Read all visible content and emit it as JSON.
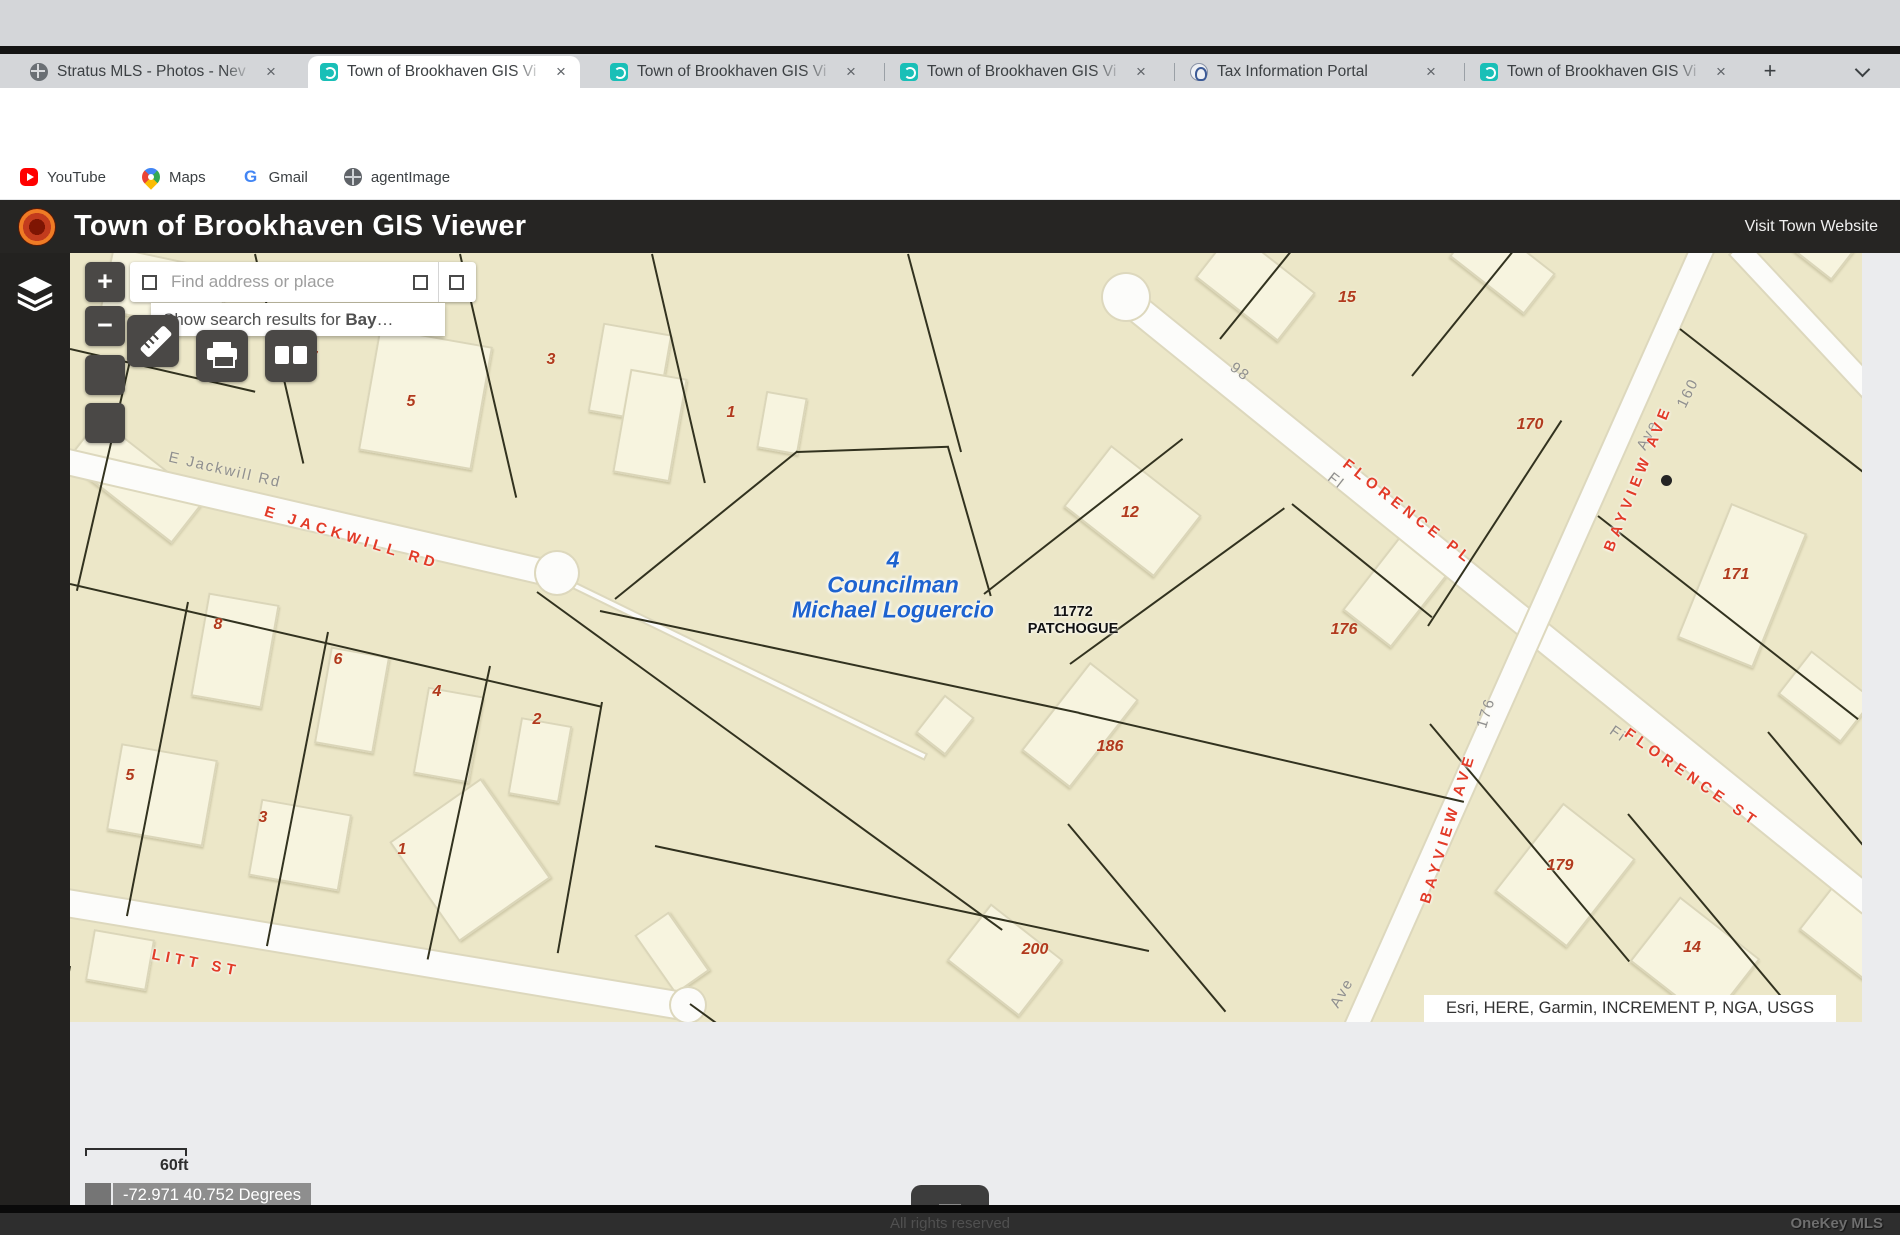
{
  "browser": {
    "tabs": [
      {
        "title": "Stratus MLS - Photos - Nev",
        "icon": "globe",
        "active": false
      },
      {
        "title": "Town of Brookhaven GIS Vi",
        "icon": "gis",
        "active": true
      },
      {
        "title": "Town of Brookhaven GIS Vi",
        "icon": "gis",
        "active": false
      },
      {
        "title": "Town of Brookhaven GIS Vi",
        "icon": "gis",
        "active": false
      },
      {
        "title": "Tax Information Portal",
        "icon": "tax",
        "active": false
      },
      {
        "title": "Town of Brookhaven GIS Vi",
        "icon": "gis",
        "active": false
      }
    ],
    "new_tab_label": "+",
    "nav": {
      "back": "←",
      "forward": "→",
      "reload": "↻"
    },
    "omnibox": {
      "info_icon": "ⓘ",
      "prefix": "File",
      "url": "/Users/sherylhecht/Downloads/Town%20of%20Brookhaven%20GIS%20Viewer.html",
      "star": "☆",
      "download": "↓"
    },
    "relaunch_label": "Relaunch to update",
    "kebab": "⋮",
    "bookmarks": [
      {
        "label": "YouTube",
        "icon": "youtube"
      },
      {
        "label": "Maps",
        "icon": "maps"
      },
      {
        "label": "Gmail",
        "icon": "gmailG",
        "glyph": "G"
      },
      {
        "label": "agentImage",
        "icon": "globe2"
      }
    ]
  },
  "header": {
    "title": "Town of Brookhaven GIS Viewer",
    "link": "Visit Town Website"
  },
  "map": {
    "zoom_in": "+",
    "zoom_out": "−",
    "search": {
      "placeholder": "Find address or place",
      "suggestion_prefix": "Show search results for ",
      "suggestion_term": "Bay",
      "suggestion_ellipsis": "…"
    },
    "attribution": "Esri, HERE, Garmin, INCREMENT P, NGA, USGS",
    "scale_label": "60ft",
    "coordinates": "-72.971 40.752 Degrees",
    "council_label": [
      "4",
      "Councilman",
      "Michael Loguercio"
    ],
    "address_label": [
      "11772",
      "PATCHOGUE"
    ],
    "parcel_numbers": [
      {
        "t": "15",
        "x": 1277,
        "y": 45
      },
      {
        "t": "7",
        "x": 243,
        "y": 105
      },
      {
        "t": "3",
        "x": 481,
        "y": 107
      },
      {
        "t": "5",
        "x": 341,
        "y": 149
      },
      {
        "t": "1",
        "x": 661,
        "y": 160
      },
      {
        "t": "170",
        "x": 1460,
        "y": 172
      },
      {
        "t": "12",
        "x": 1060,
        "y": 260
      },
      {
        "t": "171",
        "x": 1666,
        "y": 322
      },
      {
        "t": "8",
        "x": 148,
        "y": 372
      },
      {
        "t": "176",
        "x": 1274,
        "y": 377
      },
      {
        "t": "6",
        "x": 268,
        "y": 407
      },
      {
        "t": "4",
        "x": 367,
        "y": 439
      },
      {
        "t": "2",
        "x": 467,
        "y": 467
      },
      {
        "t": "186",
        "x": 1040,
        "y": 494
      },
      {
        "t": "5",
        "x": 60,
        "y": 523
      },
      {
        "t": "3",
        "x": 193,
        "y": 565
      },
      {
        "t": "1",
        "x": 332,
        "y": 597
      },
      {
        "t": "179",
        "x": 1490,
        "y": 613
      },
      {
        "t": "200",
        "x": 965,
        "y": 697
      },
      {
        "t": "14",
        "x": 1622,
        "y": 695
      }
    ],
    "street_labels_red": [
      {
        "t": "E JACKWILL RD",
        "x": 282,
        "y": 285,
        "rot": 17
      },
      {
        "t": "FLORENCE PL",
        "x": 1338,
        "y": 259,
        "rot": 38
      },
      {
        "t": "FLORENCE ST",
        "x": 1622,
        "y": 525,
        "rot": 35
      },
      {
        "t": "BAYVIEW AVE",
        "x": 1568,
        "y": 225,
        "rot": -68
      },
      {
        "t": "BAYVIEW AVE",
        "x": 1378,
        "y": 575,
        "rot": -73
      },
      {
        "t": "LITT ST",
        "x": 126,
        "y": 710,
        "rot": 11
      }
    ],
    "street_labels_gray": [
      {
        "t": "E Jackwill Rd",
        "x": 155,
        "y": 217,
        "rot": 13
      },
      {
        "t": "98",
        "x": 1170,
        "y": 119,
        "rot": 38
      },
      {
        "t": "160",
        "x": 1618,
        "y": 140,
        "rot": -64
      },
      {
        "t": "Ave",
        "x": 1578,
        "y": 182,
        "rot": -64
      },
      {
        "t": "Fl",
        "x": 1266,
        "y": 228,
        "rot": 38
      },
      {
        "t": "176",
        "x": 1416,
        "y": 460,
        "rot": -73
      },
      {
        "t": "Fi",
        "x": 1548,
        "y": 481,
        "rot": 35
      },
      {
        "t": "Ave",
        "x": 1272,
        "y": 740,
        "rot": -60
      }
    ],
    "roads": [
      {
        "x": -20,
        "y": 205,
        "len": 525,
        "w": 24,
        "rot": 13,
        "cap": true
      },
      {
        "x": 495,
        "y": 328,
        "len": 400,
        "w": 4,
        "rot": 26,
        "cap": false
      },
      {
        "x": 1048,
        "y": 40,
        "len": 980,
        "w": 26,
        "rot": 39,
        "cap": true
      },
      {
        "x": 1635,
        "y": -10,
        "len": 860,
        "w": 22,
        "rot": 114,
        "cap": false
      },
      {
        "x": 1668,
        "y": -5,
        "len": 210,
        "w": 20,
        "rot": 47,
        "cap": false
      },
      {
        "x": -15,
        "y": 648,
        "len": 645,
        "w": 26,
        "rot": 9.5,
        "cap": true
      }
    ],
    "road_bulges": [
      {
        "x": 487,
        "y": 320,
        "r": 21
      },
      {
        "x": 1056,
        "y": 44,
        "r": 23
      },
      {
        "x": 618,
        "y": 752,
        "r": 17
      }
    ],
    "buildings": [
      {
        "x": 95,
        "y": 37,
        "w": 120,
        "h": 65,
        "rot": 12
      },
      {
        "x": 355,
        "y": 145,
        "w": 115,
        "h": 125,
        "rot": 10
      },
      {
        "x": 560,
        "y": 120,
        "w": 70,
        "h": 90,
        "rot": 10
      },
      {
        "x": 580,
        "y": 172,
        "w": 58,
        "h": 105,
        "rot": 10
      },
      {
        "x": 712,
        "y": 170,
        "w": 42,
        "h": 58,
        "rot": 10
      },
      {
        "x": 65,
        "y": 227,
        "w": 135,
        "h": 55,
        "rot": 38
      },
      {
        "x": 1185,
        "y": 32,
        "w": 105,
        "h": 62,
        "rot": 38
      },
      {
        "x": 1432,
        "y": 12,
        "w": 95,
        "h": 52,
        "rot": 38
      },
      {
        "x": 1750,
        "y": -8,
        "w": 62,
        "h": 42,
        "rot": 38
      },
      {
        "x": 1062,
        "y": 258,
        "w": 115,
        "h": 78,
        "rot": 38
      },
      {
        "x": 1332,
        "y": 330,
        "w": 62,
        "h": 115,
        "rot": 38
      },
      {
        "x": 1672,
        "y": 332,
        "w": 82,
        "h": 145,
        "rot": 22
      },
      {
        "x": 165,
        "y": 397,
        "w": 72,
        "h": 105,
        "rot": 10
      },
      {
        "x": 282,
        "y": 447,
        "w": 60,
        "h": 98,
        "rot": 10
      },
      {
        "x": 378,
        "y": 482,
        "w": 57,
        "h": 88,
        "rot": 10
      },
      {
        "x": 470,
        "y": 507,
        "w": 52,
        "h": 78,
        "rot": 10
      },
      {
        "x": 92,
        "y": 542,
        "w": 98,
        "h": 88,
        "rot": 10
      },
      {
        "x": 230,
        "y": 592,
        "w": 92,
        "h": 78,
        "rot": 10
      },
      {
        "x": 400,
        "y": 607,
        "w": 112,
        "h": 122,
        "rot": -35
      },
      {
        "x": 1010,
        "y": 472,
        "w": 62,
        "h": 112,
        "rot": 38
      },
      {
        "x": 875,
        "y": 472,
        "w": 38,
        "h": 48,
        "rot": 38
      },
      {
        "x": 935,
        "y": 707,
        "w": 92,
        "h": 72,
        "rot": 38
      },
      {
        "x": 1495,
        "y": 622,
        "w": 92,
        "h": 112,
        "rot": 38
      },
      {
        "x": 1625,
        "y": 707,
        "w": 102,
        "h": 82,
        "rot": 38
      },
      {
        "x": 1780,
        "y": 677,
        "w": 82,
        "h": 62,
        "rot": 38
      },
      {
        "x": 1756,
        "y": 443,
        "w": 80,
        "h": 55,
        "rot": 38
      },
      {
        "x": 50,
        "y": 707,
        "w": 62,
        "h": 52,
        "rot": 10
      },
      {
        "x": 602,
        "y": 700,
        "w": 42,
        "h": 72,
        "rot": -35
      }
    ],
    "parcel_lines": [
      {
        "x": 185,
        "y": 0,
        "rot": 77,
        "len": 215
      },
      {
        "x": 390,
        "y": 0,
        "rot": 77,
        "len": 250
      },
      {
        "x": 582,
        "y": 0,
        "rot": 77,
        "len": 235
      },
      {
        "x": 838,
        "y": 0,
        "rot": 75,
        "len": 205
      },
      {
        "x": 0,
        "y": 95,
        "rot": 13,
        "len": 190
      },
      {
        "x": 62,
        "y": 98,
        "rot": 103,
        "len": 245
      },
      {
        "x": 0,
        "y": 330,
        "rot": 13,
        "len": 545
      },
      {
        "x": 118,
        "y": 348,
        "rot": 101,
        "len": 320
      },
      {
        "x": 258,
        "y": 378,
        "rot": 101,
        "len": 320
      },
      {
        "x": 420,
        "y": 412,
        "rot": 102,
        "len": 300
      },
      {
        "x": 532,
        "y": 448,
        "rot": 100,
        "len": 255
      },
      {
        "x": 0,
        "y": 712,
        "rot": 100,
        "len": 110
      },
      {
        "x": 0,
        "y": 790,
        "rot": 100,
        "len": 120
      },
      {
        "x": 545,
        "y": 345,
        "rot": -39,
        "len": 235
      },
      {
        "x": 727,
        "y": 198,
        "rot": -2,
        "len": 152
      },
      {
        "x": 878,
        "y": 193,
        "rot": 74,
        "len": 155
      },
      {
        "x": 530,
        "y": 357,
        "rot": 12,
        "len": 490
      },
      {
        "x": 914,
        "y": 340,
        "rot": -38,
        "len": 252
      },
      {
        "x": 1009,
        "y": 459,
        "rot": 13,
        "len": 395
      },
      {
        "x": 1000,
        "y": 410,
        "rot": -36,
        "len": 265
      },
      {
        "x": 1222,
        "y": 250,
        "rot": 39,
        "len": 180
      },
      {
        "x": 1358,
        "y": 372,
        "rot": -57,
        "len": 245
      },
      {
        "x": 1150,
        "y": 85,
        "rot": -51,
        "len": 135
      },
      {
        "x": 1342,
        "y": 122,
        "rot": -51,
        "len": 185
      },
      {
        "x": 1610,
        "y": 75,
        "rot": 38,
        "len": 235
      },
      {
        "x": 1528,
        "y": 262,
        "rot": 38,
        "len": 330
      },
      {
        "x": 467,
        "y": 338,
        "rot": 36,
        "len": 575
      },
      {
        "x": 585,
        "y": 592,
        "rot": 12,
        "len": 505
      },
      {
        "x": 998,
        "y": 570,
        "rot": 50,
        "len": 245
      },
      {
        "x": 1360,
        "y": 470,
        "rot": 50,
        "len": 310
      },
      {
        "x": 1558,
        "y": 560,
        "rot": 50,
        "len": 265
      },
      {
        "x": 1698,
        "y": 478,
        "rot": 50,
        "len": 340
      },
      {
        "x": 620,
        "y": 750,
        "rot": 36,
        "len": 260
      }
    ]
  },
  "footer": {
    "rights": "All rights reserved",
    "watermark": "OneKey MLS"
  },
  "colors": {
    "map_bg": "#ece7c8",
    "building": "#f7f4df",
    "parcel_line": "#32321f",
    "parcel_number": "#b13a1e",
    "street_red": "#e23b28",
    "council_blue": "#1e63cf",
    "header_bg": "#262523",
    "accent_teal": "#19bfb7",
    "relaunch_red": "#a50e0e"
  }
}
